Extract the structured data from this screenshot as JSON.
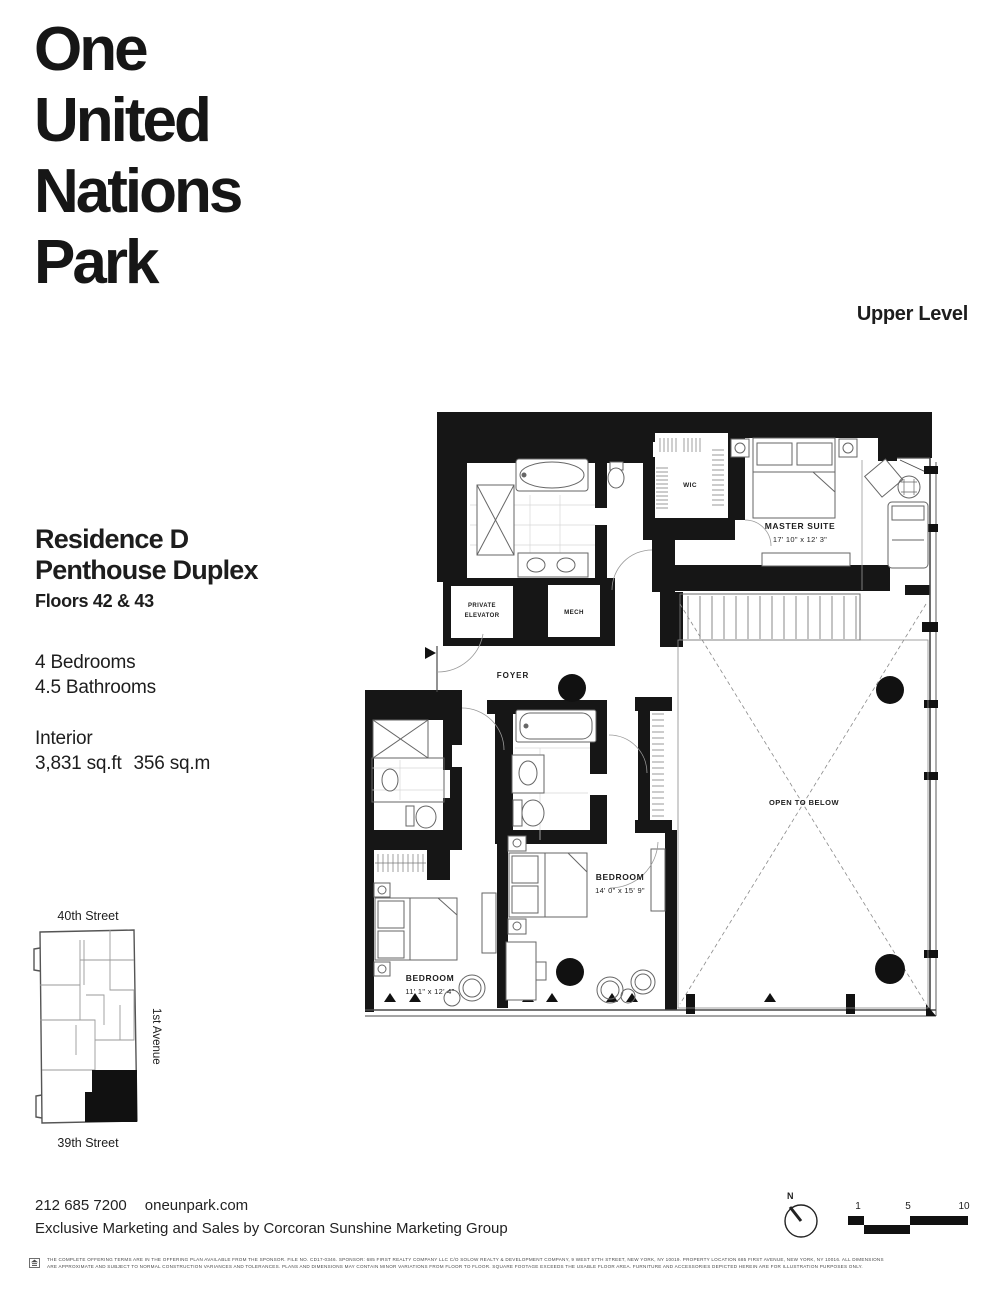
{
  "header": {
    "logo_lines": {
      "l1": "One",
      "l2": "United",
      "l3": "Nations",
      "l4": "Park"
    },
    "level_label": "Upper Level"
  },
  "residence": {
    "name": "Residence D",
    "type": "Penthouse Duplex",
    "floors": "Floors 42 & 43",
    "bedrooms": "4 Bedrooms",
    "bathrooms": "4.5 Bathrooms",
    "interior_label": "Interior",
    "area_sqft": "3,831 sq.ft",
    "area_sqm": "356 sq.m"
  },
  "site_map": {
    "top_street": "40th Street",
    "bottom_street": "39th Street",
    "side_avenue": "1st Avenue"
  },
  "plan": {
    "private_elevator_1": "PRIVATE",
    "private_elevator_2": "ELEVATOR",
    "mech": "MECH",
    "wic": "WIC",
    "foyer": "FOYER",
    "master_suite_name": "MASTER SUITE",
    "master_suite_dims": "17' 10\" x 12' 3\"",
    "bedroom2_name": "BEDROOM",
    "bedroom2_dims": "14' 0\" x 15' 9\"",
    "bedroom3_name": "BEDROOM",
    "bedroom3_dims": "11' 1\" x 12' 4\"",
    "open_to_below": "OPEN TO BELOW"
  },
  "compass": {
    "north_label": "N"
  },
  "scale_bar": {
    "tick1": "1",
    "tick2": "5",
    "tick3": "10"
  },
  "footer": {
    "phone": "212 685 7200",
    "website": "oneunpark.com",
    "marketing": "Exclusive Marketing and Sales by Corcoran Sunshine Marketing Group"
  },
  "legal": {
    "line1": "THE COMPLETE OFFERING TERMS ARE IN THE OFFERING PLAN AVAILABLE FROM THE SPONSOR. FILE NO. CD17-0346. SPONSOR: 685 FIRST REALTY COMPANY LLC C/O SOLOW REALTY & DEVELOPMENT COMPANY, 9 WEST 57TH STREET, NEW YORK, NY 10019. PROPERTY LOCATION 685 FIRST AVENUE, NEW YORK, NY 10016. ALL DIMENSIONS",
    "line2": "ARE APPROXIMATE AND SUBJECT TO NORMAL CONSTRUCTION VARIANCES AND TOLERANCES. PLANS AND DIMENSIONS MAY CONTAIN MINOR VARIATIONS FROM FLOOR TO FLOOR. SQUARE FOOTAGE EXCEEDS THE USABLE FLOOR AREA. FURNITURE AND ACCESSORIES DEPICTED HEREIN ARE FOR ILLUSTRATION PURPOSES ONLY."
  }
}
